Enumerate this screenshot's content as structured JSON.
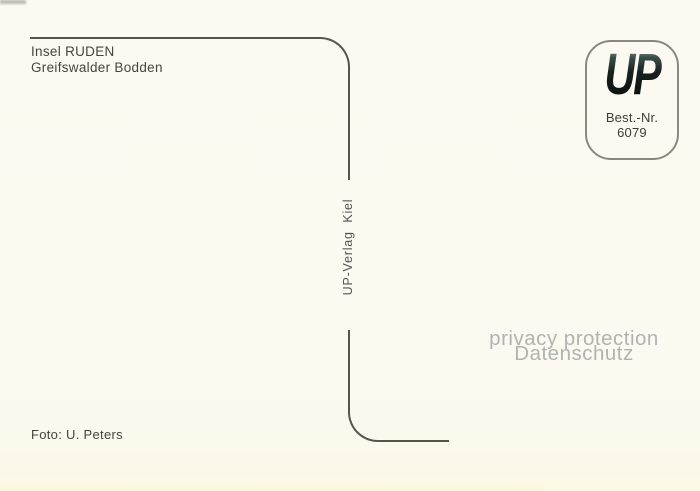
{
  "postcard": {
    "caption": {
      "line1": "Insel RUDEN",
      "line2": "Greifswalder Bodden"
    },
    "stamp_box": {
      "logo_text": "UP",
      "order_label": "Best.-Nr.",
      "order_number": "6079"
    },
    "publisher_vertical_text": "UP-Verlag  Kiel",
    "photo_credit": "Foto: U. Peters"
  },
  "watermark": {
    "line1": "privacy protection",
    "line2": "Datenschutz"
  },
  "colors": {
    "paper_background": "#fbf9f0",
    "divider_line": "#57544e",
    "caption_text": "#454540",
    "stamp_border": "#8b887f",
    "logo_teal_top": "#7d928e",
    "logo_dark": "#0a0d0c",
    "watermark_gray": "#b2b2b2"
  }
}
